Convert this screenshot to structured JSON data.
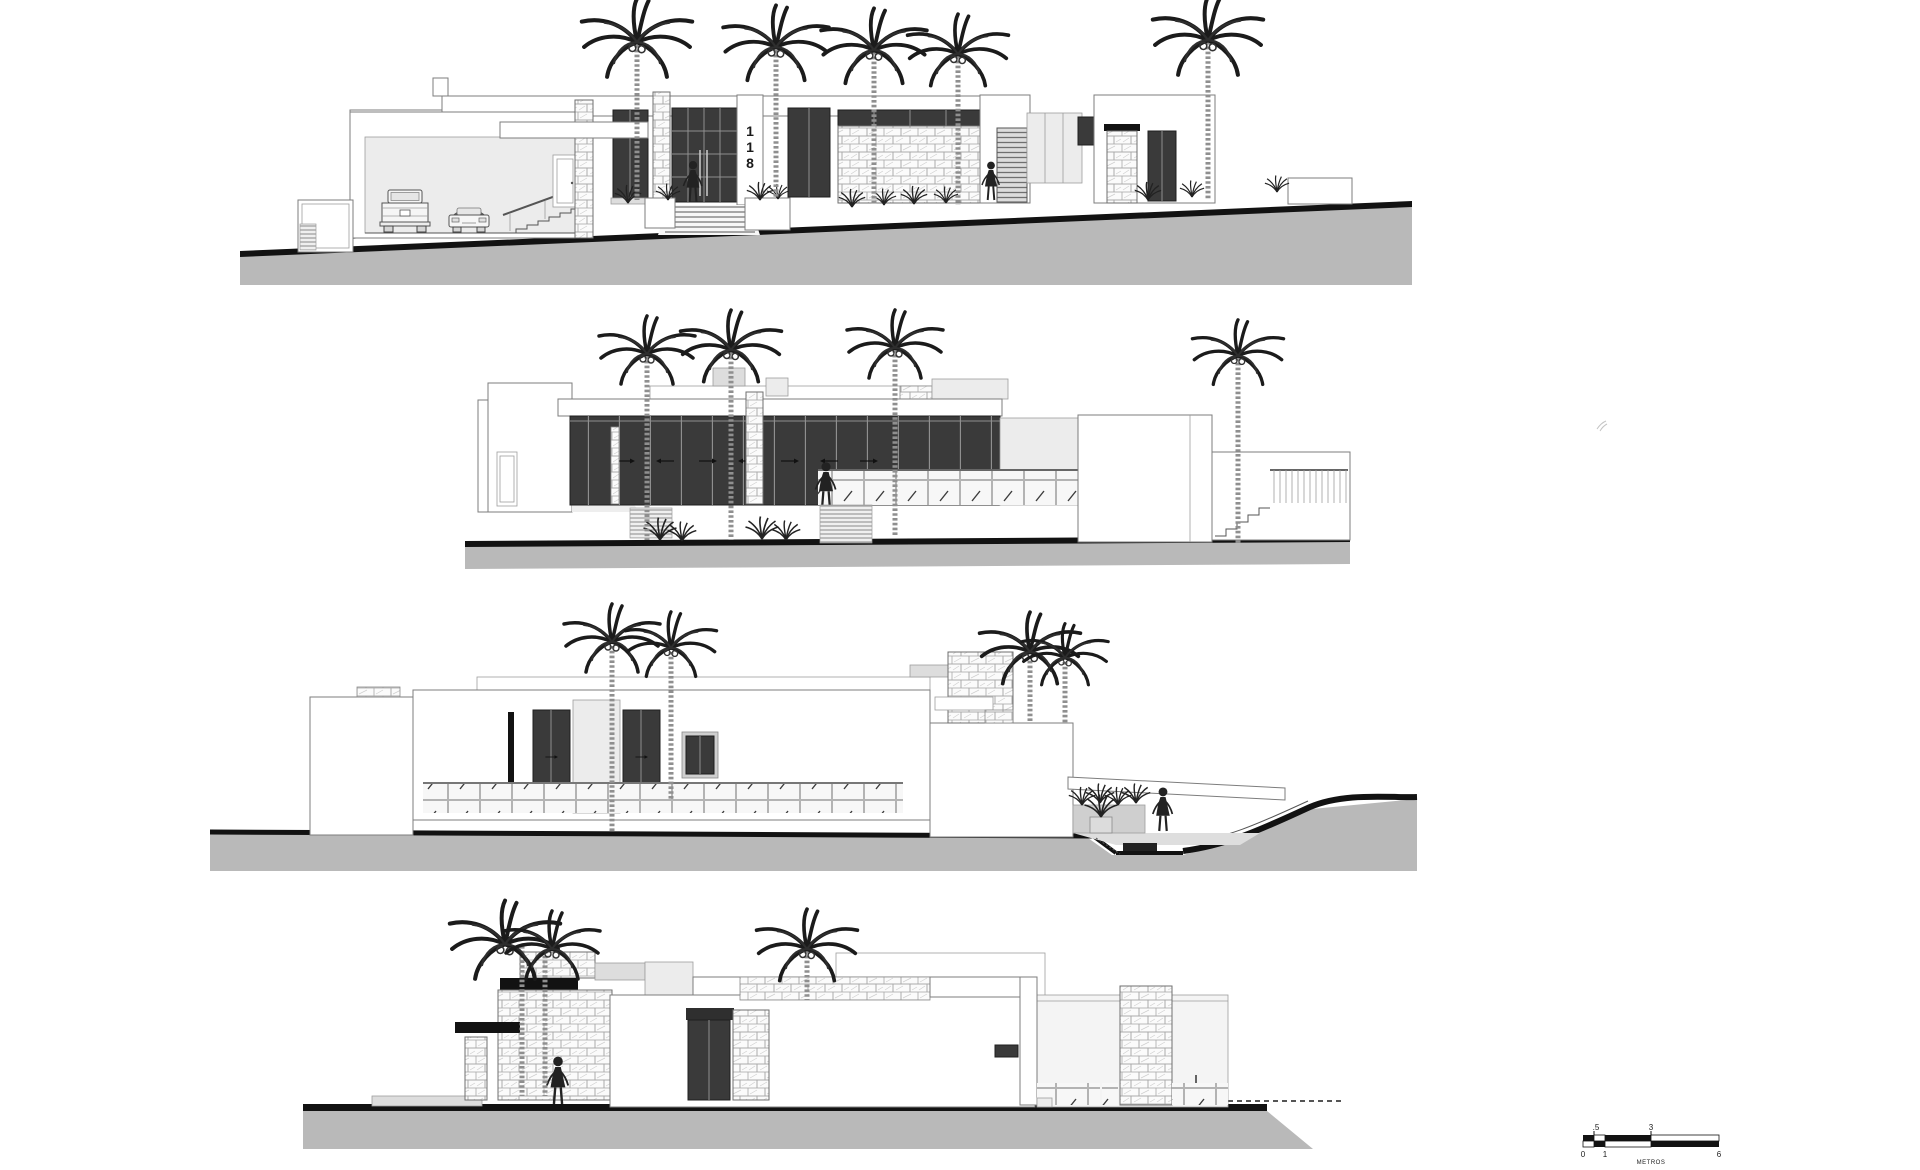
{
  "drawing": {
    "elevation_count": 4,
    "house_number": "118",
    "house_number_digits": [
      "1",
      "1",
      "8"
    ],
    "scale_bar": {
      "labels_above": [
        ".5",
        "3"
      ],
      "labels_below": [
        "0",
        "1",
        "6"
      ],
      "unit_label": "METROS"
    },
    "colors": {
      "background": "#ffffff",
      "linework": "#555555",
      "dark_glazing": "#3a3a3a",
      "black_accent": "#121212",
      "ground_fill": "#b9b9b9",
      "light_wall": "#ececec"
    },
    "icons": [
      "palm-tree-icon",
      "person-icon",
      "pickup-truck-icon",
      "car-icon",
      "plant-icon",
      "stone-texture",
      "glass-railing",
      "scale-bar"
    ]
  }
}
